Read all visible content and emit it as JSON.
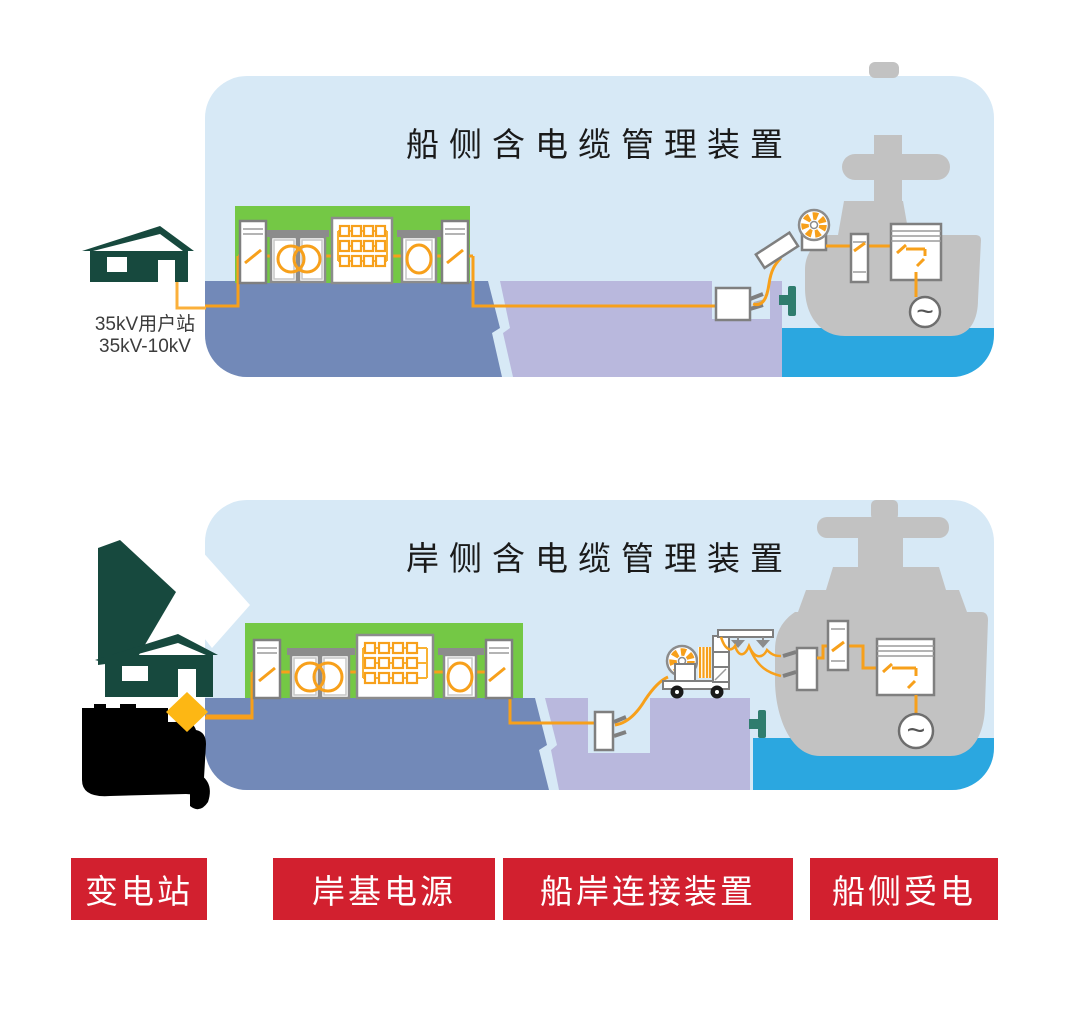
{
  "diagram": {
    "panel_ship_side": {
      "title": "船侧含电缆管理装置"
    },
    "panel_shore_side": {
      "title": "岸侧含电缆管理装置"
    },
    "substation_note": {
      "line1": "35kV用户站",
      "line2": "35kV-10kV"
    },
    "legend": [
      {
        "label": "变电站"
      },
      {
        "label": "岸基电源"
      },
      {
        "label": "船岸连接装置"
      },
      {
        "label": "船侧受电"
      }
    ],
    "icons": {
      "generator_symbol": "~",
      "substation_house_icon": "dark-teal house pictogram",
      "cable_reel_icon": "segmented orange cable reel",
      "transformer_icon": "overlapping orange circles",
      "converter_icon": "grid of orange modules",
      "ship_icon": "gray vessel silhouette"
    },
    "colors": {
      "panel_bg": "#D7E9F6",
      "shore_green": "#74C845",
      "platform_blue": "#7289B8",
      "dock_lavender": "#B9B8DD",
      "sea_blue": "#2BA7E0",
      "ship_gray": "#C2C2C2",
      "cable_orange": "#F7A01B",
      "cable_yellow": "#FBB03B",
      "building_teal": "#17493E",
      "bollard_teal": "#2F7D6E",
      "legend_red": "#D2202F",
      "diamond_gold": "#FDB714",
      "title_text": "#1A1A1A"
    }
  }
}
